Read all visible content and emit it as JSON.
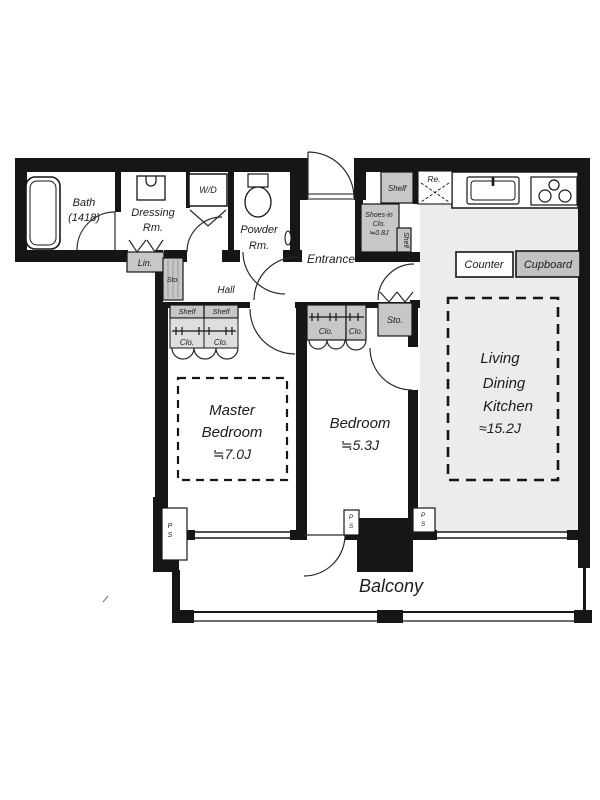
{
  "colors": {
    "wall": "#161616",
    "closet_gray": "#c7c7c7",
    "floor_gray": "#ececec",
    "text": "#1c1c1c"
  },
  "rooms": {
    "bath": {
      "l1": "Bath",
      "l2": "(1418)"
    },
    "dressing": {
      "l1": "Dressing",
      "l2": "Rm."
    },
    "wd": {
      "label": "W/D"
    },
    "powder": {
      "l1": "Powder",
      "l2": "Rm."
    },
    "lin": {
      "label": "Lin."
    },
    "sto_hall": {
      "label": "Sto."
    },
    "hall": {
      "label": "Hall"
    },
    "entrance": {
      "label": "Entrance"
    },
    "shoes_closet": {
      "l1": "Shoes-in",
      "l2": "Clo.",
      "l3": "≒0.8J"
    },
    "shelf_entry_top": {
      "label": "Shelf"
    },
    "shelf_entry_side": {
      "label": "Shelf"
    },
    "refrigerator": {
      "label": "Re."
    },
    "counter": {
      "label": "Counter"
    },
    "cupboard": {
      "label": "Cupboard"
    },
    "master_bedroom": {
      "l1": "Master",
      "l2": "Bedroom",
      "l3": "≒7.0J"
    },
    "master_closet": {
      "shelf1": "Shelf",
      "shelf2": "Shelf",
      "clo1": "Clo.",
      "clo2": "Clo."
    },
    "bedroom": {
      "l1": "Bedroom",
      "l2": "≒5.3J"
    },
    "bedroom_closet": {
      "clo1": "Clo.",
      "clo2": "Clo."
    },
    "sto_bedroom": {
      "label": "Sto."
    },
    "ldk": {
      "l1": "Living",
      "l2": "Dining",
      "l3": "Kitchen",
      "l4": "≈15.2J"
    },
    "balcony": {
      "label": "Balcony"
    },
    "pipe_space": {
      "p": "P",
      "s": "S"
    }
  }
}
